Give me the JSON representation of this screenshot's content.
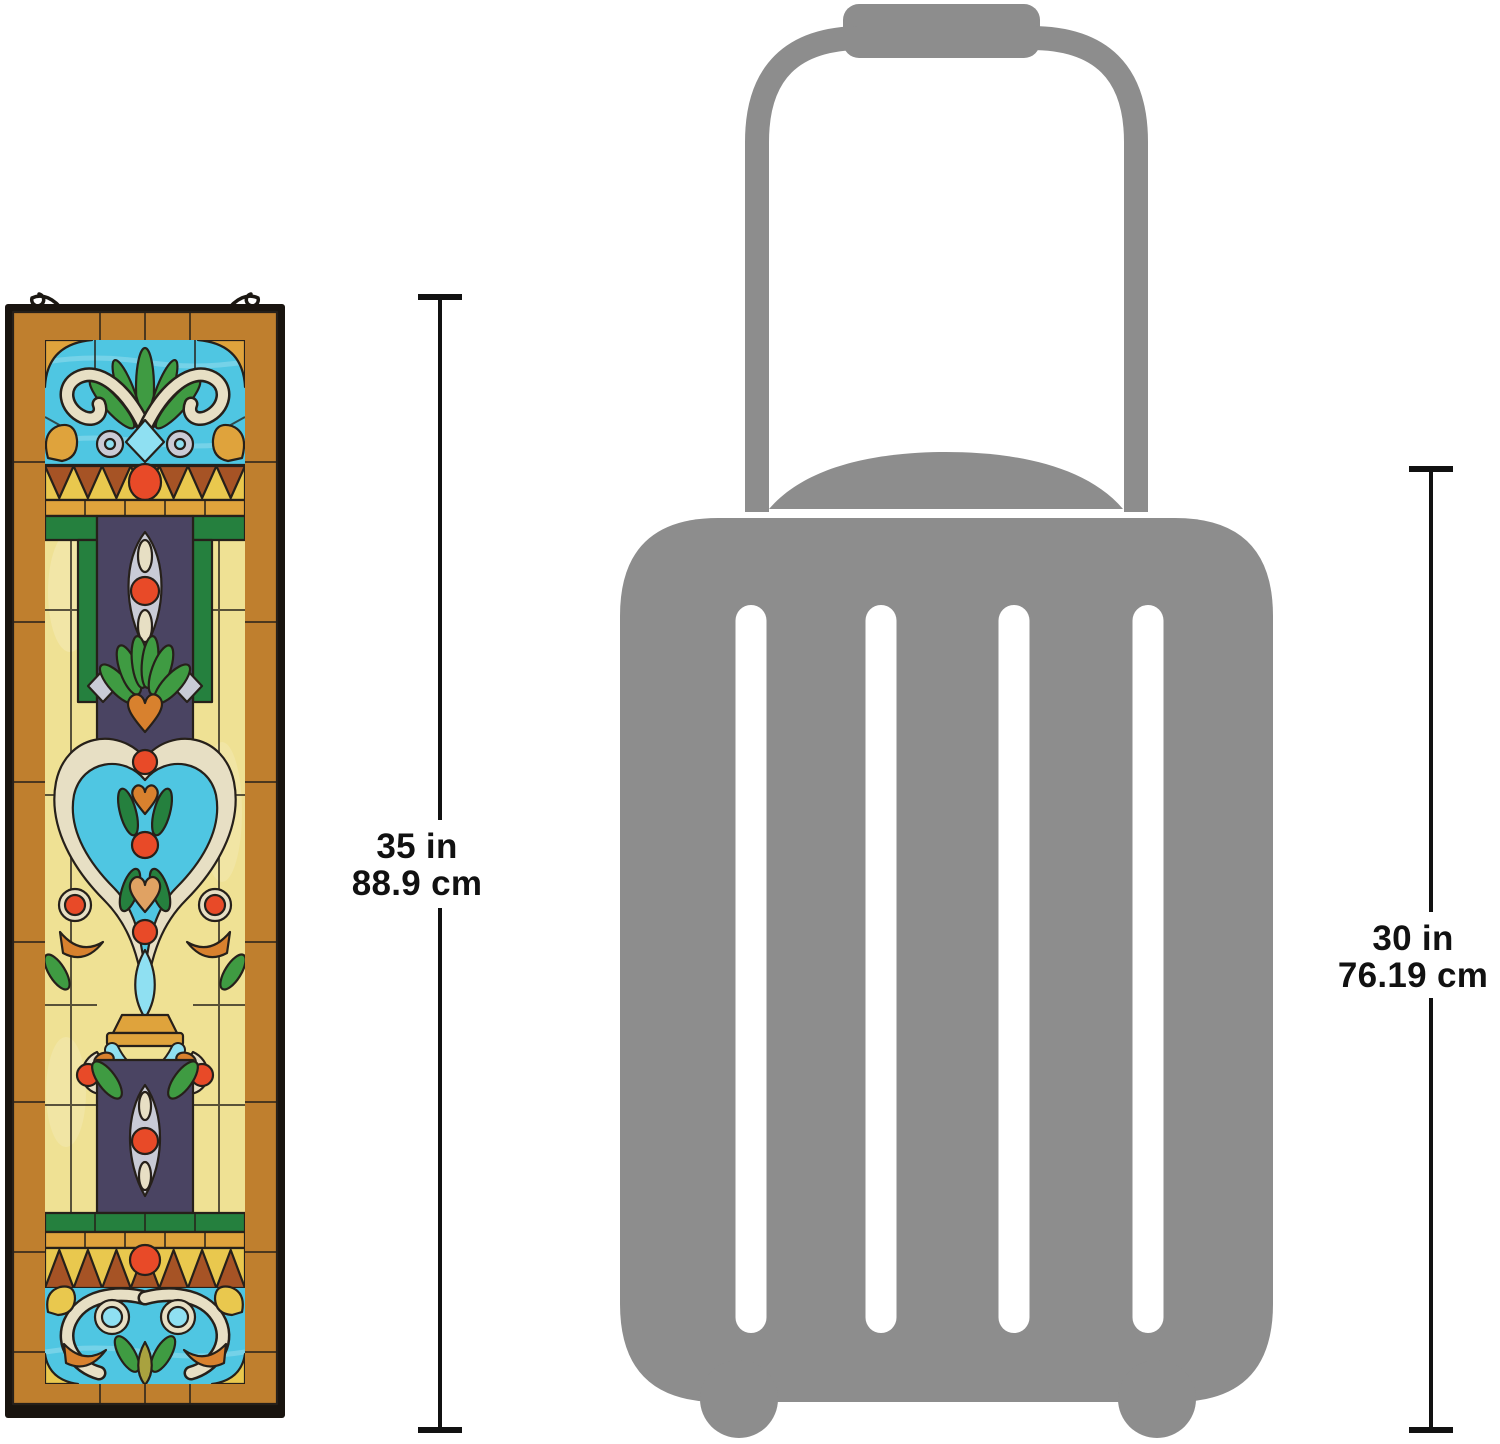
{
  "meta": {
    "description": "Product size comparison diagram: Tiffany-style stained glass window panel height versus carry-on rolling suitcase height"
  },
  "labels": {
    "panel": {
      "inches": "35 in",
      "cm": "88.9 cm"
    },
    "suitcase": {
      "inches": "30 in",
      "cm": "76.19 cm"
    }
  },
  "icons": {
    "panel": "stained-glass-panel-image",
    "panel_hooks": "hanging-hooks-icon",
    "suitcase": "suitcase-silhouette-icon",
    "dimension_lines": "measurement-line"
  },
  "colors": {
    "background": "#ffffff",
    "dim": "#111111",
    "suitcase_gray": "#8d8d8d",
    "frame_black": "#19140f",
    "border_amber": "#bf7f2e",
    "glass_turquoise": "#4fc6e2",
    "glass_turquoise_light": "#8fe0f2",
    "glass_yellow": "#efe194",
    "glass_gold": "#dfa33c",
    "glass_band_yellow": "#e9c84e",
    "glass_green": "#3f9b42",
    "glass_green_dark": "#25803e",
    "glass_olive": "#a9a23f",
    "glass_cream": "#e7dfc4",
    "glass_silver": "#c9cbd6",
    "glass_violet": "#4a4462",
    "glass_russet": "#a65325",
    "glass_orange": "#d8812e",
    "glass_peach": "#e0a263",
    "jewel_red": "#e84a28",
    "lead": "#26201a"
  }
}
